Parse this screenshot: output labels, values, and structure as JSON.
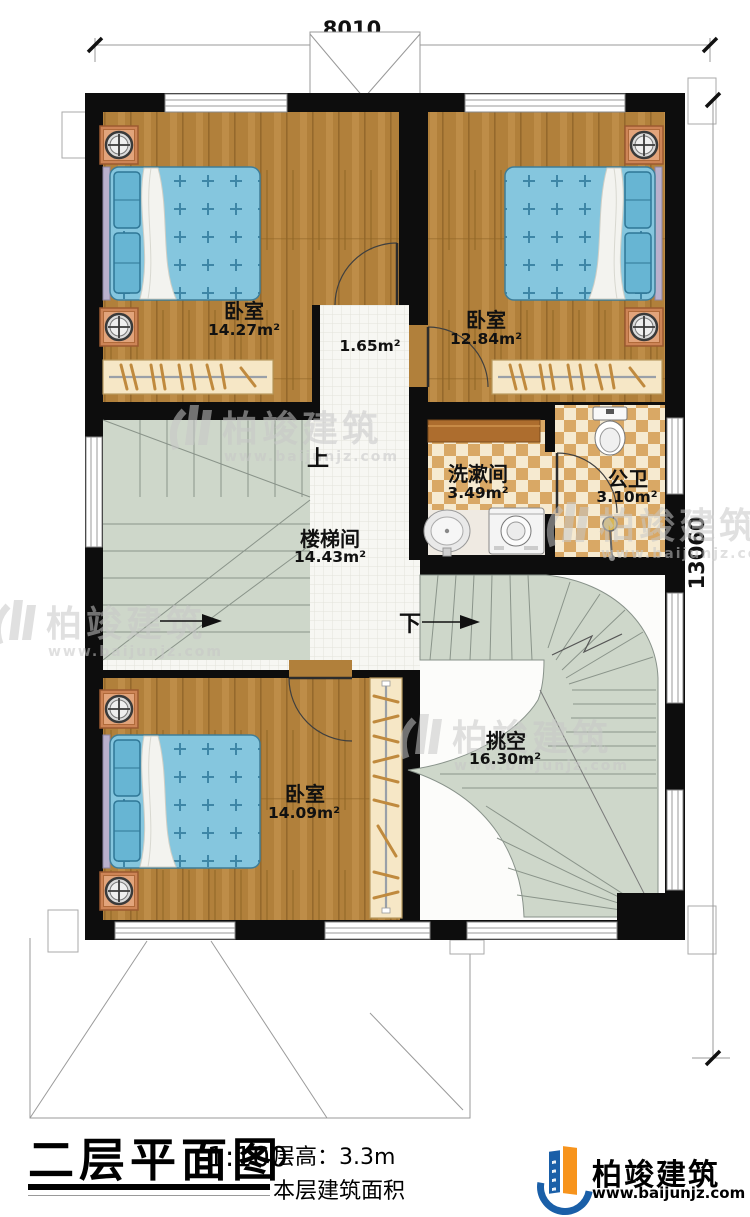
{
  "plan": {
    "dim_top": "8010",
    "dim_right": "13060",
    "rooms": {
      "bedroom_tl": {
        "name": "卧室",
        "area": "14.27m²"
      },
      "bedroom_tr": {
        "name": "卧室",
        "area": "12.84m²"
      },
      "hallway": {
        "area": "1.65m²"
      },
      "washroom": {
        "name": "洗漱间",
        "area": "3.49m²"
      },
      "bathroom": {
        "name": "公卫",
        "area": "3.10m²"
      },
      "stairwell": {
        "name": "楼梯间",
        "area": "14.43m²"
      },
      "bedroom_b": {
        "name": "卧室",
        "area": "14.09m²"
      },
      "void": {
        "name": "挑空",
        "area": "16.30m²"
      }
    },
    "stair_up": "上",
    "stair_down": "下"
  },
  "titleblock": {
    "title": "二层平面图",
    "scale": "1:100",
    "floor_height": "层高：3.3m",
    "floor_area_label": "本层建筑面积",
    "brand_name": "柏竣建筑",
    "brand_url": "www.baijunjz.com"
  },
  "watermark": {
    "name": "柏竣建筑",
    "url": "www.baijunjz.com"
  },
  "colors": {
    "wall": "#0d0d0d",
    "wood": "#b1803b",
    "bed_blue": "#85c6de",
    "stair_green": "#ced7ca",
    "checker_dark": "#d9a865",
    "checker_light": "#f6ead0",
    "brand_blue": "#1a5fa8",
    "brand_orange": "#f7941d"
  }
}
